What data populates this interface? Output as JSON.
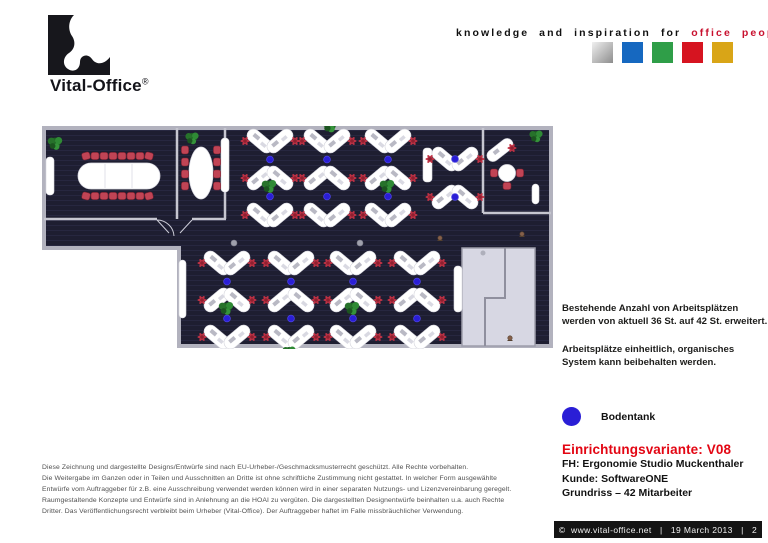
{
  "header": {
    "logo_text": "Vital-Office",
    "logo_reg": "®",
    "tagline_black": "knowledge and inspiration for",
    "tagline_red": "office people",
    "brand_squares": [
      {
        "name": "silver",
        "color": "#b9b9b9"
      },
      {
        "name": "blue",
        "color": "#1668c0"
      },
      {
        "name": "green",
        "color": "#2f9e48"
      },
      {
        "name": "red",
        "color": "#d61420"
      },
      {
        "name": "gold",
        "color": "#d9a517"
      }
    ]
  },
  "notes": {
    "para1_line1": "Bestehende Anzahl von Arbeitsplätzen",
    "para1_line2": "werden von aktuell 36 St. auf 42 St. erweitert.",
    "para2_line1": "Arbeitsplätze einheitlich, organisches",
    "para2_line2": "System kann beibehalten werden."
  },
  "legend": {
    "label": "Bodentank",
    "dot_color": "#2a1ed6"
  },
  "project": {
    "title": "Einrichtungsvariante: V08",
    "title_color": "#e30613",
    "line1": "FH: Ergonomie Studio Muckenthaler",
    "line2": "Kunde: SoftwareONE",
    "line3": "Grundriss – 42 Mitarbeiter"
  },
  "footer": {
    "copyright": "©  www.vital-office.net",
    "separator": "|",
    "date": "19 March 2013",
    "page": "2"
  },
  "disclaimer": {
    "lines": [
      "Diese Zeichnung und dargestellte Designs/Entwürfe sind nach EU-Urheber-/Geschmacksmusterrecht geschützt. Alle Rechte vorbehalten.",
      "Die Weitergabe im Ganzen oder in Teilen und Ausschnitten an Dritte ist ohne schriftliche Zustimmung nicht gestattet. In welcher Form ausgewählte",
      "Entwürfe vom Auftraggeber für z.B. eine Ausschreibung verwendet werden können wird in einer separaten Nutzungs- und Lizenzvereinbarung geregelt.",
      "Raumgestaltende Konzepte und Entwürfe sind in Anlehnung an die HOAI zu vergüten. Die dargestellten Designentwürfe beinhalten u.a. auch Rechte",
      "Dritter. Das Veröffentlichungsrecht verbleibt beim Urheber (Vital-Office). Der Auftraggeber haftet im Falle missbräuchlicher Verwendung."
    ]
  }
}
